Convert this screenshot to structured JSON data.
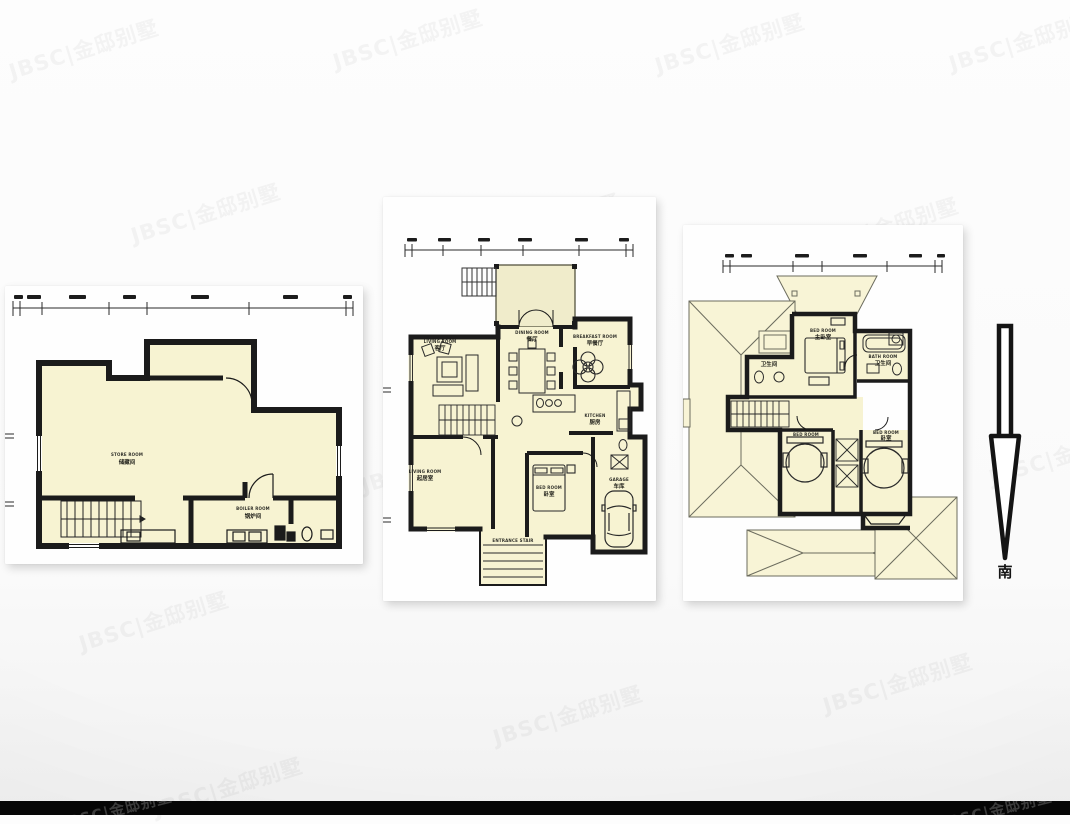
{
  "watermark": {
    "text": "JBSC|金邸别墅"
  },
  "compass": {
    "south": "南"
  },
  "basement": {
    "store_en": "STORE ROOM",
    "store_zh": "储藏间",
    "boiler_en": "BOILER ROOM",
    "boiler_zh": "锅炉间"
  },
  "floor1": {
    "living_en": "LIVING ROOM",
    "living_zh": "客厅",
    "dining_en": "DINING ROOM",
    "dining_zh": "餐厅",
    "breakfast_en": "BREAKFAST ROOM",
    "breakfast_zh": "早餐厅",
    "kitchen_en": "KITCHEN",
    "kitchen_zh": "厨房",
    "sitting_en": "LIVING ROOM",
    "sitting_zh": "起居室",
    "bedroom_en": "BED ROOM",
    "bedroom_zh": "卧室",
    "garage_en": "GARAGE",
    "garage_zh": "车库",
    "entrance_en": "ENTRANCE STAIR",
    "entrance_zh": "入户台阶"
  },
  "floor2": {
    "master_en": "BED ROOM",
    "master_zh": "主卧室",
    "bath_en": "BATH ROOM",
    "bath_zh": "卫生间",
    "bath2_zh": "卫生间",
    "bed1_en": "BED ROOM",
    "bed1_zh": "卧室",
    "bed2_en": "BED ROOM",
    "bed2_zh": "卧室"
  }
}
